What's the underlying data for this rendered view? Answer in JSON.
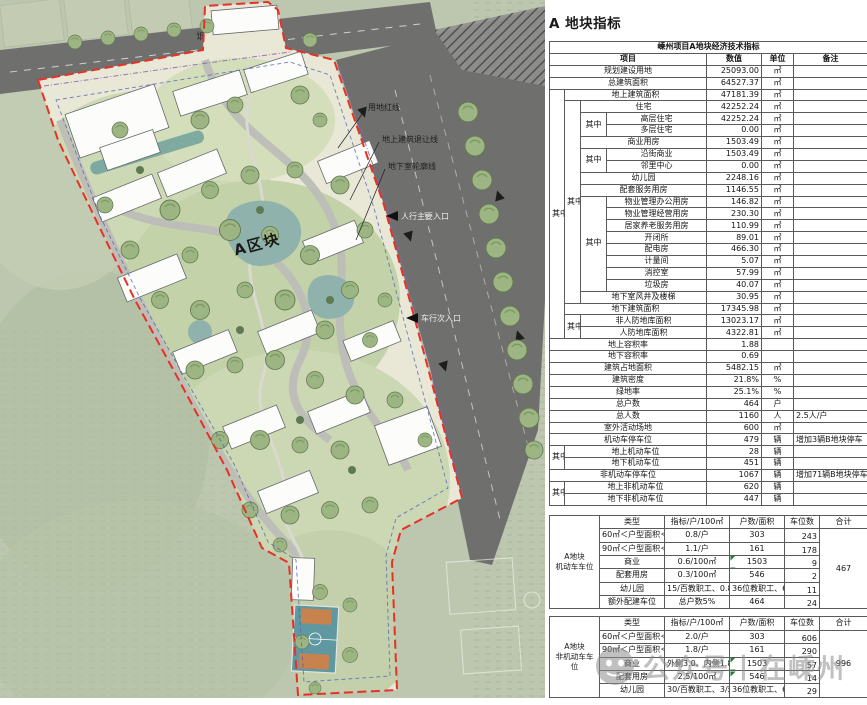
{
  "page_title": "A 地块指标",
  "plan": {
    "road_name": "城中路",
    "block_label": "A区块",
    "callouts": {
      "red_line": "用地红线",
      "setback_line": "地上建筑退让线",
      "basement_outline": "地下室轮廓线",
      "pedestrian_entrance": "人行主要入口",
      "vehicle_entrance": "车行次入口"
    }
  },
  "watermark": {
    "text": "公众号丨在嵊州"
  },
  "main_table": {
    "cols": [
      15,
      16,
      26,
      100,
      55,
      32,
      74
    ],
    "rows": [
      [
        {
          "t": "嵊州项目A地块经济技术指标",
          "cs": 7,
          "cls": "hd"
        }
      ],
      [
        {
          "t": "项目",
          "cs": 4,
          "cls": "hd"
        },
        {
          "t": "数值",
          "cls": "hd"
        },
        {
          "t": "单位",
          "cls": "hd"
        },
        {
          "t": "备注",
          "cls": "hd"
        }
      ],
      [
        {
          "t": "规划建设用地",
          "cs": 4
        },
        {
          "t": "25093.00",
          "al": "r"
        },
        {
          "t": "㎡"
        },
        {
          "t": ""
        }
      ],
      [
        {
          "t": "总建筑面积",
          "cs": 4
        },
        {
          "t": "64527.37",
          "al": "r"
        },
        {
          "t": "㎡"
        },
        {
          "t": ""
        }
      ],
      [
        {
          "t": "其中",
          "rs": 21
        },
        {
          "t": "地上建筑面积",
          "cs": 3
        },
        {
          "t": "47181.39",
          "al": "r"
        },
        {
          "t": "㎡"
        },
        {
          "t": ""
        }
      ],
      [
        {
          "t": "其中",
          "rs": 17
        },
        {
          "t": "住宅",
          "cs": 2
        },
        {
          "t": "42252.24",
          "al": "r"
        },
        {
          "t": "㎡"
        },
        {
          "t": ""
        }
      ],
      [
        {
          "t": "其中",
          "rs": 2
        },
        {
          "t": "高层住宅"
        },
        {
          "t": "42252.24",
          "al": "r"
        },
        {
          "t": "㎡"
        },
        {
          "t": ""
        }
      ],
      [
        {
          "t": "多层住宅"
        },
        {
          "t": "0.00",
          "al": "r"
        },
        {
          "t": "㎡"
        },
        {
          "t": ""
        }
      ],
      [
        {
          "t": "商业用房",
          "cs": 2
        },
        {
          "t": "1503.49",
          "al": "r"
        },
        {
          "t": "㎡"
        },
        {
          "t": ""
        }
      ],
      [
        {
          "t": "其中",
          "rs": 2
        },
        {
          "t": "沿街商业"
        },
        {
          "t": "1503.49",
          "al": "r"
        },
        {
          "t": "㎡"
        },
        {
          "t": ""
        }
      ],
      [
        {
          "t": "邻里中心"
        },
        {
          "t": "0.00",
          "al": "r"
        },
        {
          "t": "㎡"
        },
        {
          "t": ""
        }
      ],
      [
        {
          "t": "幼儿园",
          "cs": 2
        },
        {
          "t": "2248.16",
          "al": "r"
        },
        {
          "t": "㎡"
        },
        {
          "t": ""
        }
      ],
      [
        {
          "t": "配套服务用房",
          "cs": 2
        },
        {
          "t": "1146.55",
          "al": "r"
        },
        {
          "t": "㎡"
        },
        {
          "t": ""
        }
      ],
      [
        {
          "t": "其中",
          "rs": 8
        },
        {
          "t": "物业管理办公用房"
        },
        {
          "t": "146.82",
          "al": "r"
        },
        {
          "t": "㎡"
        },
        {
          "t": ""
        }
      ],
      [
        {
          "t": "物业管理经营用房"
        },
        {
          "t": "230.30",
          "al": "r"
        },
        {
          "t": "㎡"
        },
        {
          "t": ""
        }
      ],
      [
        {
          "t": "居家养老服务用房"
        },
        {
          "t": "110.99",
          "al": "r"
        },
        {
          "t": "㎡"
        },
        {
          "t": ""
        }
      ],
      [
        {
          "t": "开闭所"
        },
        {
          "t": "89.01",
          "al": "r"
        },
        {
          "t": "㎡"
        },
        {
          "t": ""
        }
      ],
      [
        {
          "t": "配电房"
        },
        {
          "t": "466.30",
          "al": "r"
        },
        {
          "t": "㎡"
        },
        {
          "t": ""
        }
      ],
      [
        {
          "t": "计量间"
        },
        {
          "t": "5.07",
          "al": "r"
        },
        {
          "t": "㎡"
        },
        {
          "t": ""
        }
      ],
      [
        {
          "t": "消控室"
        },
        {
          "t": "57.99",
          "al": "r"
        },
        {
          "t": "㎡"
        },
        {
          "t": ""
        }
      ],
      [
        {
          "t": "垃圾房"
        },
        {
          "t": "40.07",
          "al": "r"
        },
        {
          "t": "㎡"
        },
        {
          "t": ""
        }
      ],
      [
        {
          "t": "地下室风井及楼梯",
          "cs": 2
        },
        {
          "t": "30.95",
          "al": "r"
        },
        {
          "t": "㎡"
        },
        {
          "t": ""
        }
      ],
      [
        {
          "t": "地下建筑面积",
          "cs": 3
        },
        {
          "t": "17345.98",
          "al": "r"
        },
        {
          "t": "㎡"
        },
        {
          "t": ""
        }
      ],
      [
        {
          "t": "其中",
          "rs": 2
        },
        {
          "t": "非人防地库面积",
          "cs": 2
        },
        {
          "t": "13023.17",
          "al": "r"
        },
        {
          "t": "㎡"
        },
        {
          "t": ""
        }
      ],
      [
        {
          "t": "人防地库面积",
          "cs": 2
        },
        {
          "t": "4322.81",
          "al": "r"
        },
        {
          "t": "㎡"
        },
        {
          "t": ""
        }
      ],
      [
        {
          "t": "地上容积率",
          "cs": 4
        },
        {
          "t": "1.88",
          "al": "r"
        },
        {
          "t": ""
        },
        {
          "t": ""
        }
      ],
      [
        {
          "t": "地下容积率",
          "cs": 4
        },
        {
          "t": "0.69",
          "al": "r"
        },
        {
          "t": ""
        },
        {
          "t": ""
        }
      ],
      [
        {
          "t": "建筑占地面积",
          "cs": 4
        },
        {
          "t": "5482.15",
          "al": "r"
        },
        {
          "t": "㎡"
        },
        {
          "t": ""
        }
      ],
      [
        {
          "t": "建筑密度",
          "cs": 4
        },
        {
          "t": "21.8%",
          "al": "r"
        },
        {
          "t": "%"
        },
        {
          "t": ""
        }
      ],
      [
        {
          "t": "绿地率",
          "cs": 4
        },
        {
          "t": "25.1%",
          "al": "r"
        },
        {
          "t": "%"
        },
        {
          "t": ""
        }
      ],
      [
        {
          "t": "总户数",
          "cs": 4
        },
        {
          "t": "464",
          "al": "r"
        },
        {
          "t": "户"
        },
        {
          "t": ""
        }
      ],
      [
        {
          "t": "总人数",
          "cs": 4
        },
        {
          "t": "1160",
          "al": "r"
        },
        {
          "t": "人"
        },
        {
          "t": "2.5人/户",
          "al": "l"
        }
      ],
      [
        {
          "t": "室外活动场地",
          "cs": 4
        },
        {
          "t": "600",
          "al": "r"
        },
        {
          "t": "㎡"
        },
        {
          "t": ""
        }
      ],
      [
        {
          "t": "机动车停车位",
          "cs": 4
        },
        {
          "t": "479",
          "al": "r"
        },
        {
          "t": "辆"
        },
        {
          "t": "增加3辆B地块停车",
          "al": "l"
        }
      ],
      [
        {
          "t": "其中",
          "rs": 2
        },
        {
          "t": "地上机动车位",
          "cs": 3
        },
        {
          "t": "28",
          "al": "r"
        },
        {
          "t": "辆"
        },
        {
          "t": ""
        }
      ],
      [
        {
          "t": "地下机动车位",
          "cs": 3
        },
        {
          "t": "451",
          "al": "r"
        },
        {
          "t": "辆"
        },
        {
          "t": ""
        }
      ],
      [
        {
          "t": "非机动车停车位",
          "cs": 4
        },
        {
          "t": "1067",
          "al": "r"
        },
        {
          "t": "辆"
        },
        {
          "t": "增加71辆B地块停车",
          "al": "l"
        }
      ],
      [
        {
          "t": "其中",
          "rs": 2
        },
        {
          "t": "地上非机动车位",
          "cs": 3
        },
        {
          "t": "620",
          "al": "r"
        },
        {
          "t": "辆"
        },
        {
          "t": ""
        }
      ],
      [
        {
          "t": "地下非机动车位",
          "cs": 3
        },
        {
          "t": "447",
          "al": "r"
        },
        {
          "t": "辆"
        },
        {
          "t": ""
        }
      ]
    ]
  },
  "parking_table": {
    "cols": [
      50,
      65,
      65,
      55,
      35,
      48
    ],
    "rows": [
      [
        {
          "t": "A地块\n机动车车位",
          "rs": 7,
          "cls": "side"
        },
        {
          "t": "类型"
        },
        {
          "t": "指标/户/100㎡"
        },
        {
          "t": "户数/面积"
        },
        {
          "t": "车位数"
        },
        {
          "t": "合计"
        }
      ],
      [
        {
          "t": "60㎡＜户型面积＜90㎡"
        },
        {
          "t": "0.8/户"
        },
        {
          "t": "303"
        },
        {
          "t": "243",
          "al": "rb"
        },
        {
          "t": "467",
          "rs": 6
        }
      ],
      [
        {
          "t": "90㎡＜户型面积＜144㎡"
        },
        {
          "t": "1.1/户"
        },
        {
          "t": "161"
        },
        {
          "t": "178",
          "al": "rb"
        }
      ],
      [
        {
          "t": "商业"
        },
        {
          "t": "0.6/100㎡"
        },
        {
          "t": "1503",
          "cls": "tri"
        },
        {
          "t": "9",
          "al": "rb"
        }
      ],
      [
        {
          "t": "配套用房"
        },
        {
          "t": "0.3/100㎡"
        },
        {
          "t": "546"
        },
        {
          "t": "2",
          "al": "rb"
        }
      ],
      [
        {
          "t": "幼儿园"
        },
        {
          "t": "15/百教职工、0.8/班"
        },
        {
          "t": "36位教职工、6班"
        },
        {
          "t": "11",
          "al": "rb"
        }
      ],
      [
        {
          "t": "额外配建车位"
        },
        {
          "t": "总户数5%"
        },
        {
          "t": "464"
        },
        {
          "t": "24",
          "al": "rb"
        }
      ]
    ]
  },
  "nonmotor_table": {
    "cols": [
      50,
      65,
      65,
      55,
      35,
      48
    ],
    "rows": [
      [
        {
          "t": "A地块\n非机动车车位",
          "rs": 6,
          "cls": "side"
        },
        {
          "t": "类型"
        },
        {
          "t": "指标/户/100㎡"
        },
        {
          "t": "户数/面积"
        },
        {
          "t": "车位数"
        },
        {
          "t": "合计"
        }
      ],
      [
        {
          "t": "60㎡＜户型面积＜90㎡"
        },
        {
          "t": "2.0/户"
        },
        {
          "t": "303"
        },
        {
          "t": "606",
          "al": "rb"
        },
        {
          "t": "996",
          "rs": 5
        }
      ],
      [
        {
          "t": "90㎡＜户型面积＜144㎡"
        },
        {
          "t": "1.8/户"
        },
        {
          "t": "161"
        },
        {
          "t": "290",
          "al": "rb"
        }
      ],
      [
        {
          "t": "商业"
        },
        {
          "t": "外侧3.0、内侧1.8"
        },
        {
          "t": "1503",
          "cls": "tri"
        },
        {
          "t": "57",
          "al": "rb"
        }
      ],
      [
        {
          "t": "配套用房"
        },
        {
          "t": "2.5/100㎡"
        },
        {
          "t": "546",
          "cls": "tri"
        },
        {
          "t": "14",
          "al": "rb"
        }
      ],
      [
        {
          "t": "幼儿园"
        },
        {
          "t": "30/百教职工、3/班"
        },
        {
          "t": "36位教职工、6班"
        },
        {
          "t": "29",
          "al": "rb"
        }
      ]
    ]
  }
}
